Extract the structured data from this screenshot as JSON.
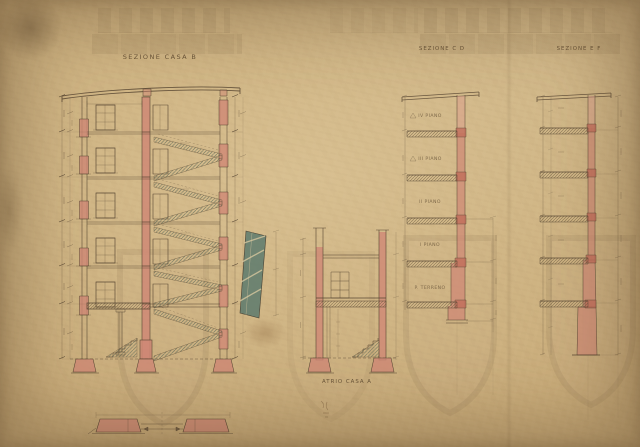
{
  "document": {
    "kind": "scanned hand-inked architectural section drawing",
    "language": "Italian"
  },
  "sections": {
    "main": {
      "title": "SEZIONE CASA B"
    },
    "cd": {
      "title": "SEZIONE C D",
      "floor_labels": [
        "IV PIANO",
        "III PIANO",
        "II PIANO",
        "I PIANO",
        "P. TERRENO"
      ]
    },
    "ef": {
      "title": "SEZIONE E F"
    },
    "atrio": {
      "title": "ATRIO CASA A"
    }
  },
  "palette": {
    "paper": "#c4a779",
    "paper_shadow": "#93764c",
    "paper_highlight": "#e8d4a8",
    "ink": "#584733",
    "wall_pink": "#cf8875",
    "wall_pink_dark": "#c06e5b",
    "stair_teal": "#5d7a6d",
    "hatch_cream": "#d8c89f"
  }
}
